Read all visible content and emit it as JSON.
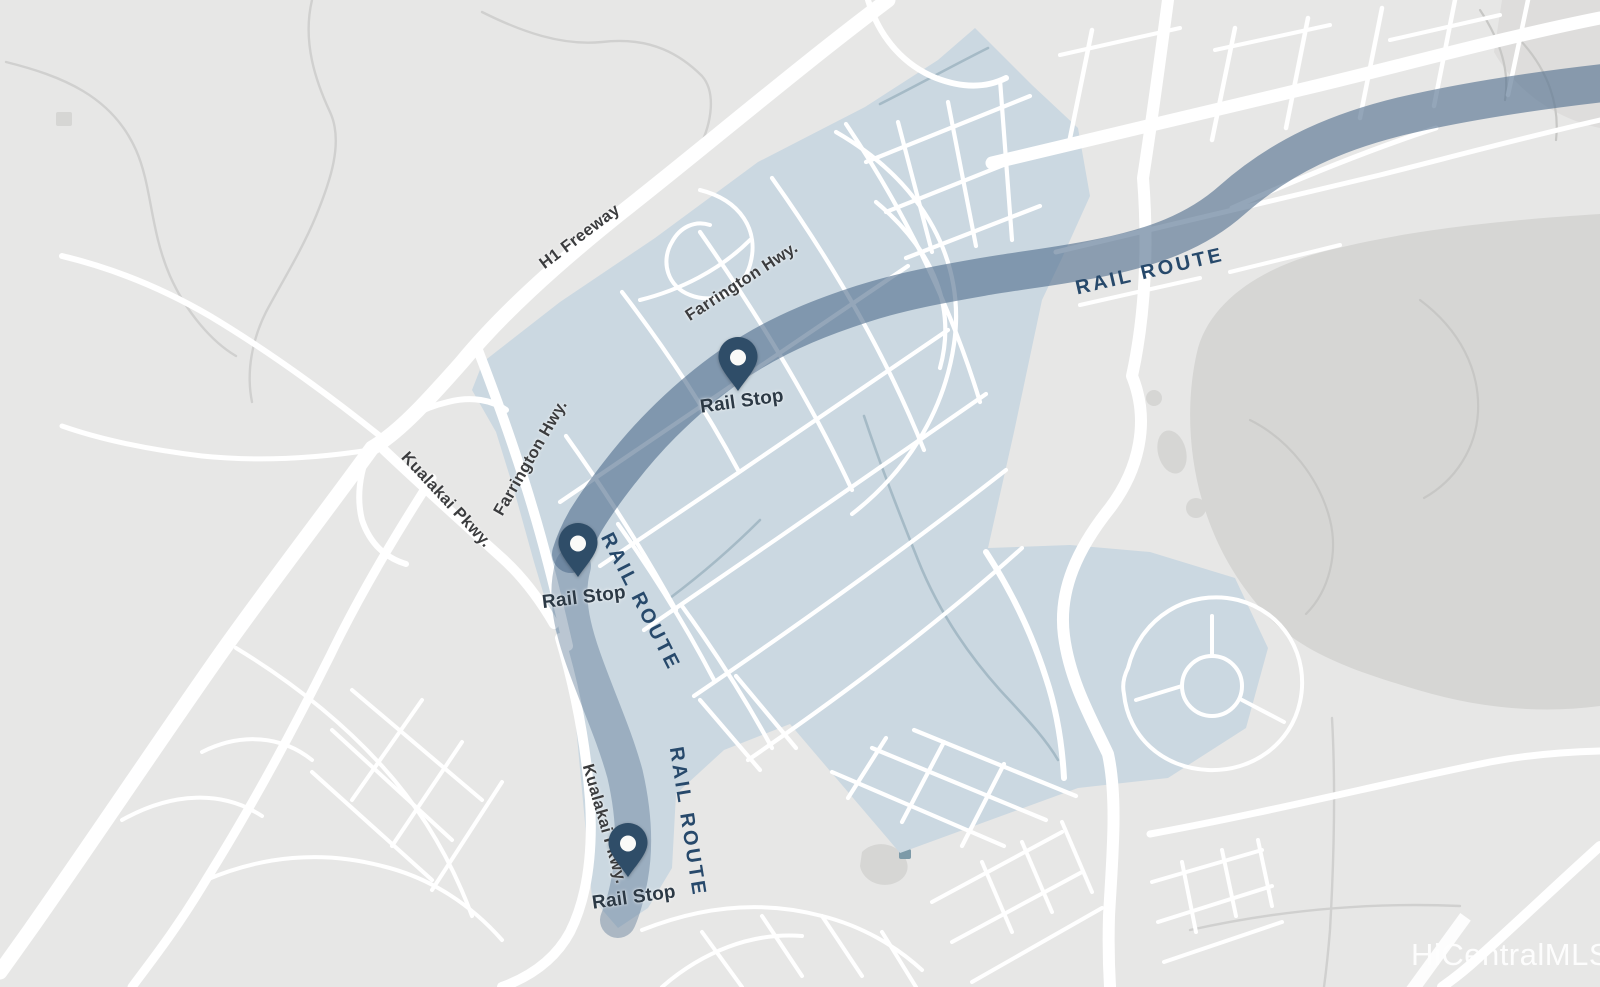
{
  "map": {
    "colors": {
      "background": "#e7e7e6",
      "terrain": "#d6d6d4",
      "terrain_soft": "#dedddc",
      "region_highlight": "#cbd8e1",
      "road": "#ffffff",
      "rail_route": "#52708e",
      "stream": "#a5bac6",
      "trail": "#d0d0cf",
      "pin": "#2f4d68",
      "pin_dot": "#fafaf8",
      "road_label_text": "#3b3c3e",
      "stop_label_text": "#2c3945",
      "rail_label_text": "#27496b",
      "watermark_text": "#ffffff"
    },
    "road_labels": {
      "h1_freeway": "H1 Freeway",
      "farrington_hwy_upper": "Farrington Hwy.",
      "farrington_hwy_lower": "Farrington Hwy.",
      "kualakai_pkwy_upper": "Kualakai Pkwy.",
      "kualakai_pkwy_lower": "Kualakai Pkwy."
    },
    "rail": {
      "route_labels": {
        "northeast": "RAIL ROUTE",
        "central": "RAIL ROUTE",
        "south": "RAIL ROUTE"
      },
      "stops": [
        {
          "label": "Rail Stop"
        },
        {
          "label": "Rail Stop"
        },
        {
          "label": "Rail Stop"
        }
      ]
    },
    "attribution": {
      "watermark": "HiCentralMLS"
    }
  }
}
